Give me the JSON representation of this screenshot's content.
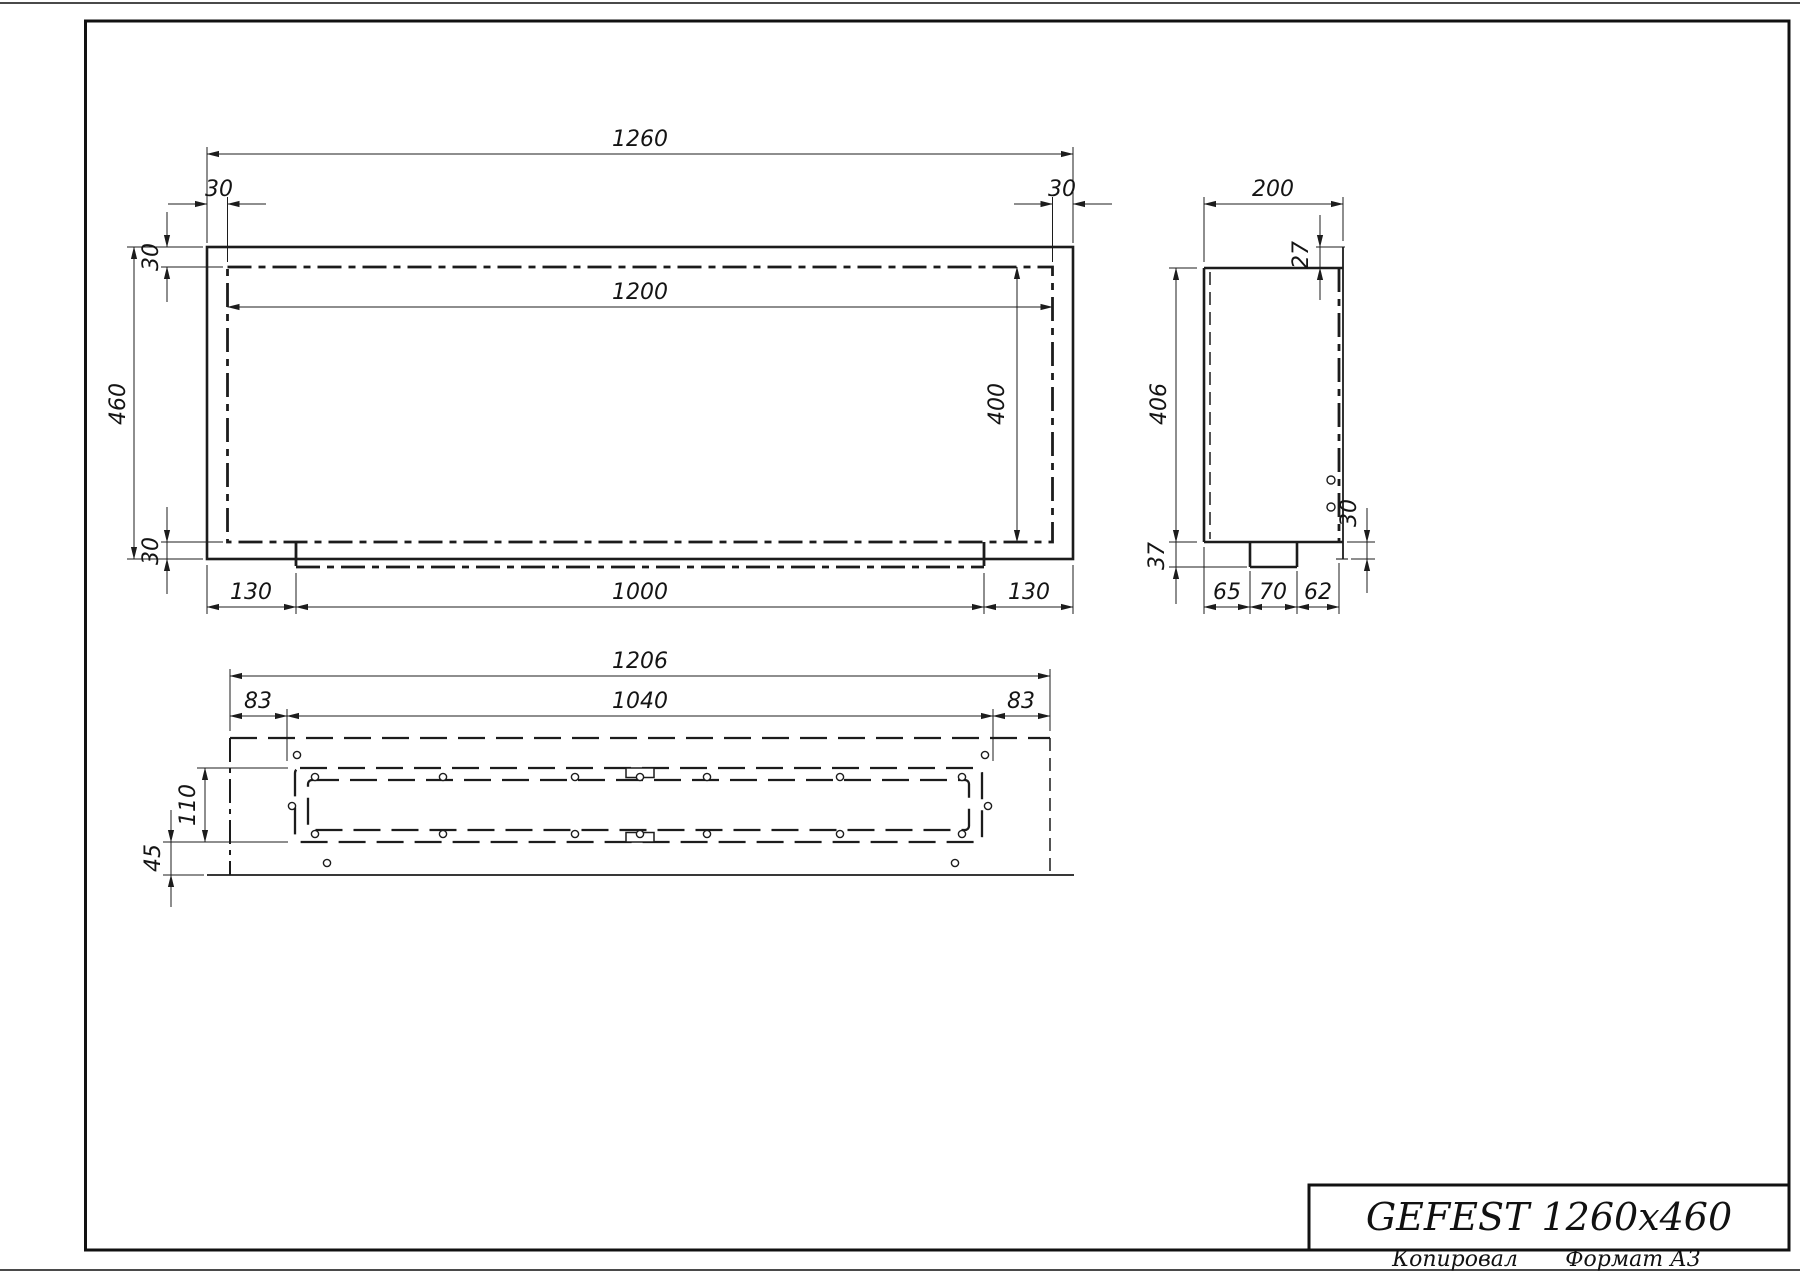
{
  "title_block": {
    "product_title": "GEFEST 1260x460",
    "copied_label": "Копировал",
    "format_label": "Формат А3"
  },
  "front_view": {
    "dim_total_width": "1260",
    "dim_flange_left": "30",
    "dim_flange_right": "30",
    "dim_opening_width": "1200",
    "dim_total_height": "460",
    "dim_wall_top": "30",
    "dim_wall_bottom": "30",
    "dim_tray_offset_left": "130",
    "dim_tray_width": "1000",
    "dim_tray_offset_right": "130",
    "dim_opening_height": "400"
  },
  "side_view": {
    "dim_depth": "200",
    "dim_top_lip": "27",
    "dim_body_height": "406",
    "dim_tray_drop": "37",
    "dim_flange_drop": "30",
    "dim_seg_left": "65",
    "dim_seg_middle": "70",
    "dim_seg_right": "62"
  },
  "plan_view": {
    "dim_body_width": "1206",
    "dim_margin_left": "83",
    "dim_frame_width": "1040",
    "dim_margin_right": "83",
    "dim_frame_depth": "110",
    "dim_front_gap": "45"
  }
}
